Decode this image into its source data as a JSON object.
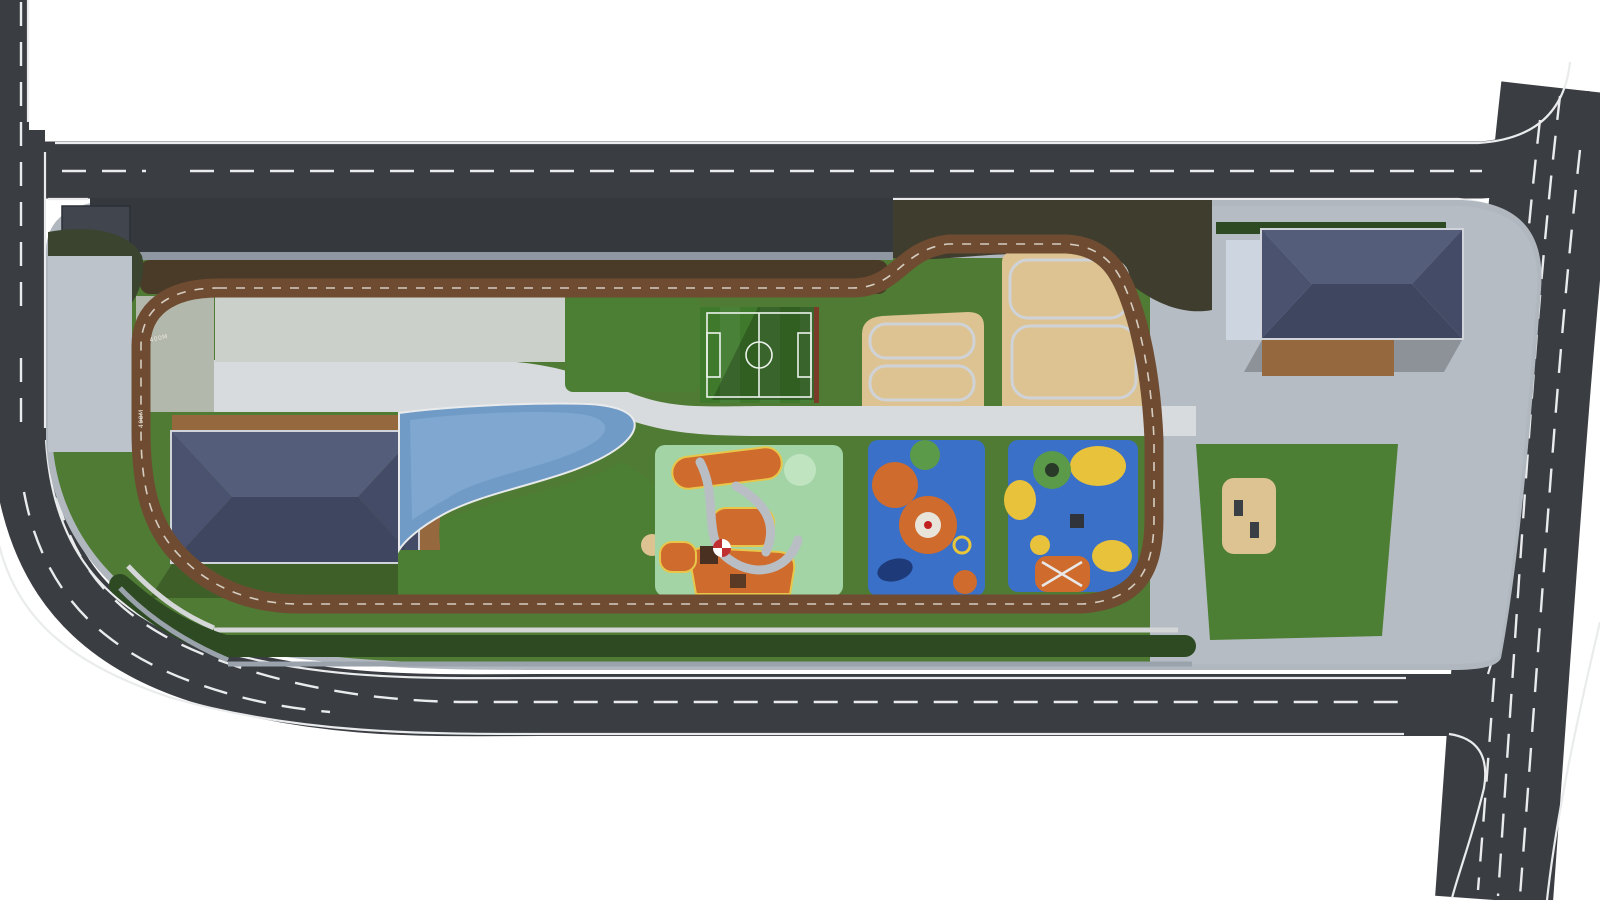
{
  "meta": {
    "title": "Community Park - Aerial Site Plan Rendering"
  },
  "track": {
    "marking": "400M"
  },
  "palette": {
    "asphalt": "#3a3d42",
    "laneLine": "#e9ebec",
    "sidewalk": "#b0b7bf",
    "plaza": "#b5bcc4",
    "lawn": "#507b34",
    "soil": "#4a3a28",
    "trackBrown": "#6f4c31",
    "hedge": "#2d4a23",
    "sand": "#dcc391",
    "water": "#6f9bc6",
    "roof": "#49506a",
    "woodDeck": "#95683e",
    "playgroundGreen": "#a2d4a5",
    "playgroundBlue": "#3a70c8",
    "playgroundOrange": "#cf6b2c",
    "rock": "#ccd5e0",
    "benchBlue": "#56688c",
    "benchWood": "#8a5f3a",
    "fitnessRed": "#c03a22",
    "treeTones": [
      "#2e5223",
      "#3c662c",
      "#4e7f38",
      "#659646",
      "#82b054"
    ],
    "pinkTree": "#b565a8",
    "lightTree": "#8fbe5c",
    "carColors": {
      "white": "#e6e7e9",
      "red": "#b32622",
      "blue": "#3d7bc8",
      "black": "#16181b",
      "silver": "#b9bec4",
      "navy": "#2a3a6e",
      "olive": "#5c6a4e",
      "lightblue": "#86b4d8",
      "gray": "#878c93",
      "darkgray": "#3f4348"
    }
  },
  "parking": {
    "stalls": {
      "start": 226,
      "end": 886,
      "step": 22,
      "y": 202,
      "len": 50
    },
    "cars": [
      {
        "x": 335,
        "color": "red"
      },
      {
        "x": 357,
        "color": "white"
      },
      {
        "x": 392,
        "color": "white"
      },
      {
        "x": 414,
        "color": "white"
      },
      {
        "x": 436,
        "color": "darkgray"
      },
      {
        "x": 478,
        "color": "white"
      },
      {
        "x": 540,
        "color": "blue"
      },
      {
        "x": 562,
        "color": "white"
      },
      {
        "x": 604,
        "color": "black"
      },
      {
        "x": 626,
        "color": "darkgray"
      },
      {
        "x": 648,
        "color": "white"
      },
      {
        "x": 728,
        "color": "white"
      },
      {
        "x": 750,
        "color": "lightblue"
      },
      {
        "x": 790,
        "color": "white"
      },
      {
        "x": 812,
        "color": "white"
      },
      {
        "x": 834,
        "color": "olive"
      },
      {
        "x": 858,
        "color": "navy"
      }
    ]
  },
  "roadCars": [
    {
      "x": 703,
      "y": 147,
      "w": 38,
      "h": 17,
      "rot": 0,
      "color": "white"
    },
    {
      "x": 1251,
      "y": 150,
      "w": 34,
      "h": 15,
      "rot": 0,
      "color": "white"
    },
    {
      "x": 1260,
      "y": 176,
      "w": 36,
      "h": 15,
      "rot": 0,
      "color": "white"
    },
    {
      "x": 11,
      "y": 396,
      "w": 23,
      "h": 40,
      "rot": 0,
      "color": "white"
    },
    {
      "x": 686,
      "y": 679,
      "w": 40,
      "h": 17,
      "rot": 0,
      "color": "silver"
    },
    {
      "x": 1190,
      "y": 703,
      "w": 34,
      "h": 14,
      "rot": -2,
      "color": "gray"
    },
    {
      "x": 1553,
      "y": 329,
      "w": 23,
      "h": 45,
      "rot": 6,
      "color": "black"
    },
    {
      "x": 1542,
      "y": 431,
      "w": 22,
      "h": 34,
      "rot": 5,
      "color": "white"
    },
    {
      "x": 1524,
      "y": 516,
      "w": 22,
      "h": 42,
      "rot": 5,
      "color": "black"
    },
    {
      "x": 1563,
      "y": 601,
      "w": 22,
      "h": 40,
      "rot": 5,
      "color": "white"
    },
    {
      "x": 1480,
      "y": 762,
      "w": 20,
      "h": 38,
      "rot": 7,
      "color": "navy"
    },
    {
      "x": 1513,
      "y": 842,
      "w": 23,
      "h": 44,
      "rot": 8,
      "color": "white"
    }
  ],
  "crosswalks": [
    {
      "x": 152,
      "y": 147,
      "bars": 6,
      "dir": "h",
      "len": 32,
      "rot": 0
    },
    {
      "x": 1494,
      "y": 146,
      "bars": 6,
      "dir": "h",
      "len": 32,
      "rot": 0
    },
    {
      "x": 3,
      "y": 322,
      "bars": 5,
      "dir": "v",
      "len": 30,
      "rot": 0
    },
    {
      "x": 272,
      "y": 690,
      "bars": 6,
      "dir": "h",
      "len": 36,
      "rot": 8
    },
    {
      "x": 1409,
      "y": 678,
      "bars": 7,
      "dir": "h",
      "len": 37,
      "rot": 0
    }
  ],
  "trees": {
    "topRow": {
      "x0": 168,
      "x1": 876,
      "step": 44,
      "y": 272
    },
    "scatter": [
      [
        905,
        232,
        17,
        2
      ],
      [
        938,
        222,
        15,
        3
      ],
      [
        972,
        220,
        14,
        2
      ],
      [
        1006,
        219,
        15,
        3
      ],
      [
        1042,
        220,
        16,
        2
      ],
      [
        1076,
        224,
        15,
        3
      ],
      [
        1108,
        232,
        16,
        2
      ],
      [
        1134,
        250,
        15,
        3
      ],
      [
        1150,
        274,
        14,
        2
      ],
      [
        1160,
        300,
        13,
        3
      ],
      [
        925,
        258,
        12,
        1
      ],
      [
        958,
        248,
        11,
        2
      ],
      [
        1162,
        470,
        16,
        2
      ],
      [
        1174,
        514,
        17,
        3
      ],
      [
        1158,
        554,
        15,
        2
      ],
      [
        1178,
        590,
        16,
        3
      ],
      [
        1150,
        620,
        13,
        2
      ],
      [
        1166,
        334,
        13,
        3
      ],
      [
        1170,
        372,
        13,
        2
      ],
      [
        1168,
        410,
        13,
        3
      ],
      [
        1172,
        444,
        12,
        2
      ],
      [
        700,
        600,
        13,
        1
      ],
      [
        762,
        604,
        15,
        2
      ],
      [
        860,
        600,
        14,
        1
      ],
      [
        932,
        606,
        16,
        2
      ],
      [
        1002,
        600,
        14,
        1
      ],
      [
        1062,
        608,
        15,
        2
      ],
      [
        1112,
        600,
        13,
        1
      ],
      [
        66,
        248,
        15,
        2
      ],
      [
        98,
        262,
        13,
        3
      ],
      [
        80,
        298,
        12,
        2
      ],
      [
        120,
        246,
        11,
        3
      ],
      [
        140,
        258,
        12,
        2
      ],
      [
        60,
        328,
        10,
        2
      ],
      [
        252,
        318,
        11,
        1
      ],
      [
        312,
        344,
        9,
        2
      ],
      [
        368,
        316,
        10,
        1
      ],
      [
        432,
        344,
        9,
        2
      ],
      [
        472,
        318,
        8,
        1
      ],
      [
        524,
        344,
        9,
        2
      ],
      [
        430,
        394,
        11,
        2
      ],
      [
        472,
        398,
        10,
        3
      ],
      [
        540,
        396,
        11,
        2
      ],
      [
        612,
        398,
        10,
        3
      ],
      [
        692,
        302,
        9,
        2
      ],
      [
        824,
        302,
        9,
        3
      ],
      [
        690,
        402,
        9,
        3
      ],
      [
        822,
        402,
        9,
        2
      ],
      [
        1306,
        500,
        19,
        1
      ],
      [
        1338,
        560,
        21,
        2
      ],
      [
        1292,
        602,
        14,
        1
      ],
      [
        1372,
        472,
        12,
        2
      ],
      [
        1398,
        560,
        12,
        1
      ],
      [
        1215,
        560,
        11,
        2
      ],
      [
        1262,
        622,
        12,
        1
      ],
      [
        1348,
        632,
        13,
        2
      ],
      [
        1404,
        228,
        14,
        2
      ],
      [
        1448,
        247,
        15,
        3
      ],
      [
        1492,
        302,
        14,
        2
      ],
      [
        1480,
        334,
        13,
        3
      ],
      [
        1462,
        396,
        14,
        2
      ],
      [
        1450,
        518,
        14,
        3
      ],
      [
        1458,
        556,
        15,
        2
      ],
      [
        1432,
        606,
        14,
        3
      ],
      [
        1238,
        252,
        12,
        2
      ],
      [
        1208,
        262,
        13,
        1
      ],
      [
        1198,
        302,
        11,
        2
      ],
      [
        1240,
        354,
        12,
        3
      ],
      [
        1310,
        390,
        10,
        2
      ],
      [
        1342,
        388,
        9,
        3
      ]
    ],
    "pink": [
      [
        560,
        330,
        13
      ],
      [
        596,
        362,
        11
      ],
      [
        588,
        440,
        15
      ],
      [
        452,
        572,
        13
      ],
      [
        556,
        586,
        14
      ],
      [
        620,
        520,
        10
      ],
      [
        286,
        344,
        9
      ],
      [
        342,
        316,
        8
      ]
    ],
    "light": [
      505,
      505,
      36
    ]
  },
  "palms": [
    [
      118,
      424
    ],
    [
      104,
      468
    ],
    [
      108,
      514
    ],
    [
      132,
      556
    ],
    [
      168,
      588
    ],
    [
      214,
      606
    ],
    [
      432,
      470
    ],
    [
      432,
      532
    ],
    [
      434,
      580
    ],
    [
      662,
      437
    ],
    [
      700,
      434
    ],
    [
      764,
      434
    ],
    [
      806,
      436
    ],
    [
      864,
      436
    ],
    [
      902,
      437
    ],
    [
      962,
      438
    ],
    [
      1002,
      438
    ],
    [
      1032,
      436
    ],
    [
      1064,
      438
    ],
    [
      1096,
      436
    ],
    [
      1124,
      438
    ],
    [
      685,
      618
    ]
  ],
  "flowers": {
    "x0": 218,
    "step": 45,
    "w": 40,
    "rows": [
      {
        "y": 302,
        "h": 27,
        "colors": [
          "#9a50b8",
          "#c0569f",
          "#4c7a34",
          "#b84a28",
          "#d8c040",
          "#9a50b8",
          "#cc7ab8",
          "#4c7a34"
        ]
      },
      {
        "y": 333,
        "h": 25,
        "colors": [
          "#b84a28",
          "#cc7ab8",
          "#9a50b8",
          "#4c7a34",
          "#c0569f",
          "#d8c040",
          "#9a50b8",
          "#b84a28"
        ]
      }
    ],
    "leftBeds": [
      [
        172,
        316,
        10,
        "#c0569f"
      ],
      [
        186,
        352,
        9,
        "#b84a28"
      ],
      [
        166,
        380,
        8,
        "#4c7a34"
      ]
    ],
    "planters": [
      [
        238,
        296,
        26,
        5
      ],
      [
        398,
        296,
        26,
        5
      ],
      [
        300,
        358,
        30,
        5
      ],
      [
        470,
        358,
        30,
        5
      ]
    ]
  },
  "fitness": [
    [
      880,
      394
    ],
    [
      904,
      368
    ],
    [
      928,
      386
    ],
    [
      948,
      350
    ],
    [
      914,
      336
    ],
    [
      886,
      354
    ],
    [
      1022,
      280
    ],
    [
      1058,
      316
    ],
    [
      1040,
      350
    ],
    [
      1088,
      290
    ],
    [
      1098,
      350
    ],
    [
      1068,
      388
    ],
    [
      1112,
      376
    ],
    [
      1034,
      396
    ]
  ],
  "steps": [
    {
      "x": 984,
      "y": 246,
      "w": 20,
      "h": 162,
      "gap": 9,
      "cls": "f-stone"
    },
    {
      "x": 1126,
      "y": 298,
      "w": 66,
      "h": 134,
      "gap": 11,
      "cls": "f-plaza2"
    },
    {
      "x": 845,
      "y": 436,
      "w": 24,
      "h": 158,
      "gap": 12,
      "cls": "f-pave"
    },
    {
      "x": 984,
      "y": 436,
      "w": 26,
      "h": 158,
      "gap": 12,
      "cls": "f-pave"
    },
    {
      "x": 1140,
      "y": 436,
      "w": 26,
      "h": 158,
      "gap": 12,
      "cls": "f-plaza2"
    },
    {
      "x": 818,
      "y": 300,
      "w": 26,
      "h": 106,
      "gap": 10,
      "cls": "f-pave"
    },
    {
      "x": 678,
      "y": 300,
      "w": 22,
      "h": 106,
      "gap": 26,
      "cls": "f-prom"
    },
    {
      "x": 1196,
      "y": 416,
      "w": 196,
      "h": 26,
      "gap": 7,
      "cls": "f-plaza2"
    },
    {
      "x": 646,
      "y": 248,
      "w": 34,
      "h": 150,
      "gap": 6,
      "cls": "f-wood"
    }
  ],
  "cascade": {
    "n": 6,
    "x0": 1248,
    "dx": 32,
    "yTop": 378,
    "yBot": 434
  },
  "amphitheater": {
    "rowsX": [
      1210,
      1230,
      1250,
      1280,
      1300,
      1320,
      1350,
      1370
    ]
  },
  "bleachers": {
    "cols": [
      844,
      856,
      868
    ],
    "y": 302,
    "h": 96,
    "planterYs": [
      318,
      352,
      386
    ]
  },
  "pondJets": {
    "x0": 420,
    "x1": 556,
    "y0": 436,
    "y1": 470,
    "step": 14
  },
  "tables": {
    "deck1Top": {
      "x0": 300,
      "x1": 412,
      "step": 18,
      "y": 424
    },
    "deck1Right": {
      "x": 429,
      "y0": 452,
      "y1": 582,
      "step": 22
    },
    "deck2": {
      "x0": 1272,
      "x1": 1384,
      "step": 16,
      "ys": [
        352,
        366
      ]
    }
  },
  "hedgeDots": {
    "x0": 230,
    "x1": 1186,
    "step": 26,
    "y": 646,
    "extra": [
      [
        150,
        572
      ],
      [
        168,
        592
      ],
      [
        190,
        606
      ],
      [
        210,
        622
      ],
      [
        130,
        548
      ],
      [
        118,
        520
      ]
    ]
  },
  "plazaGrid": {
    "x0": 1152,
    "x1": 1538,
    "y0": 208,
    "y1": 662,
    "step": 22
  },
  "lightPoles": [
    [
      1402,
      296,
      70
    ],
    [
      1424,
      432,
      70
    ],
    [
      1392,
      524,
      70
    ]
  ],
  "people": [
    [
      92,
      372,
      "#c03030"
    ],
    [
      290,
      324,
      "#2a2d31"
    ],
    [
      318,
      366,
      "#3a3d41"
    ],
    [
      560,
      318,
      "#2a2d31"
    ],
    [
      905,
      300,
      "#c03030"
    ],
    [
      1250,
      560,
      "#2a2d31"
    ],
    [
      1470,
      700,
      "#2a2d31"
    ],
    [
      685,
      562,
      "#c8ccd0"
    ],
    [
      760,
      300,
      "#2a2d31"
    ]
  ]
}
